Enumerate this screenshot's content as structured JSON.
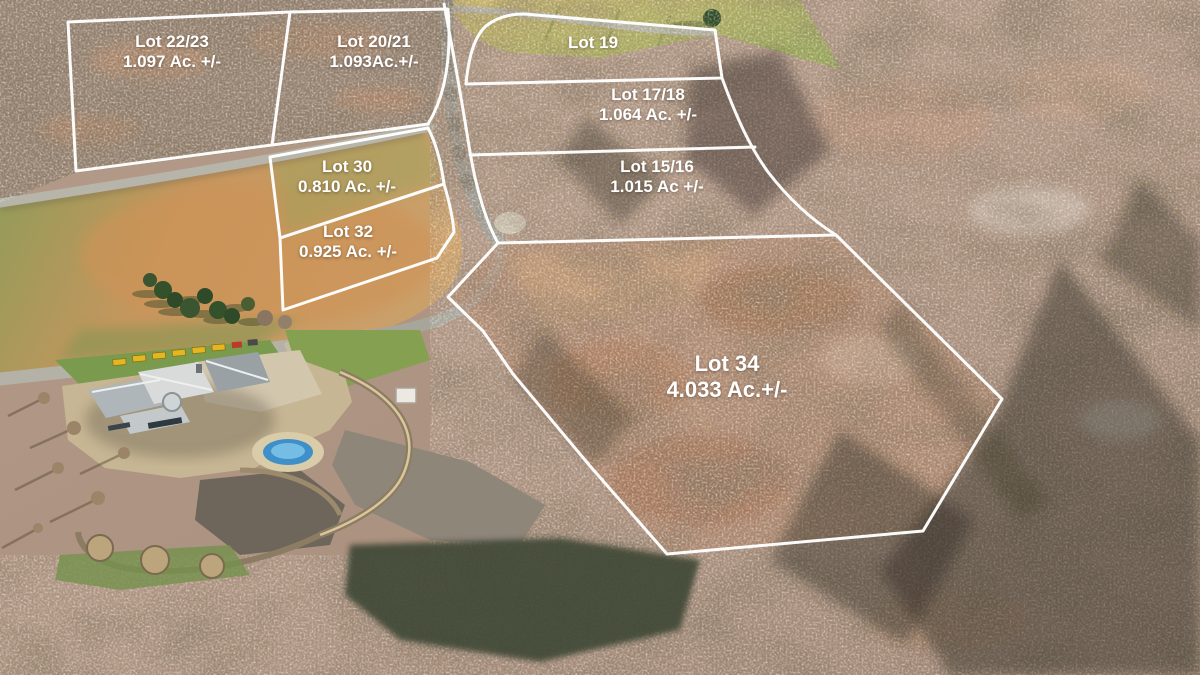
{
  "map": {
    "kind": "aerial-lot-plat",
    "description": "Aerial drone photo of wooded acreage and estate with surveyed lot boundaries overlaid in white"
  },
  "lots": [
    {
      "key": "lot-22-23",
      "name": "Lot 22/23",
      "acreage": "1.097 Ac. +/-"
    },
    {
      "key": "lot-20-21",
      "name": "Lot 20/21",
      "acreage": "1.093Ac.+/-"
    },
    {
      "key": "lot-19",
      "name": "Lot 19",
      "acreage": ""
    },
    {
      "key": "lot-17-18",
      "name": "Lot 17/18",
      "acreage": "1.064 Ac. +/-"
    },
    {
      "key": "lot-15-16",
      "name": "Lot 15/16",
      "acreage": "1.015 Ac +/-"
    },
    {
      "key": "lot-30",
      "name": "Lot 30",
      "acreage": "0.810 Ac. +/-"
    },
    {
      "key": "lot-32",
      "name": "Lot 32",
      "acreage": "0.925 Ac. +/-"
    },
    {
      "key": "lot-34",
      "name": "Lot 34",
      "acreage": "4.033 Ac.+/-"
    }
  ],
  "boundaries": [
    {
      "key": "block-lots-22-23-20-21",
      "path": "M 68,22 L 290,12 L 448,9 C 452,60 444,98 428,124 L 272,145 L 76,171 Z"
    },
    {
      "key": "divider-22-23-20-21",
      "path": "M 290,12 L 272,145"
    },
    {
      "key": "lot-19-outline",
      "path": "M 524,14 L 715,30 L 722,78 L 466,84 C 469,52 476,35 486,26 C 496,18 509,14 524,14 Z"
    },
    {
      "key": "road-east-edge",
      "path": "M 444,4 C 454,56 462,102 470,152 C 476,188 486,222 498,243"
    },
    {
      "key": "east-boundary-curve",
      "path": "M 722,78 C 738,122 752,150 768,172 C 788,198 812,220 836,235"
    },
    {
      "key": "divider-15-16",
      "path": "M 470,155 L 755,147"
    },
    {
      "key": "lot-34-outline",
      "path": "M 498,243 L 836,235 L 1002,399 L 923,531 L 667,554 L 590,466 L 513,374 L 483,331 L 448,297 Z"
    },
    {
      "key": "lot-30-outline",
      "path": "M 270,157 L 428,128 C 436,143 441,162 444,184 L 280,238 Z"
    },
    {
      "key": "lot-32-outline",
      "path": "M 280,238 L 444,184 C 450,204 453,220 454,232 L 437,258 L 283,310 Z"
    }
  ],
  "colors": {
    "boundary_line": "#ffffff",
    "label_text": "#ffffff",
    "forest_canopy": "#b59a88",
    "forest_shadow": "#2e2a22",
    "field_green": "#8d9c58",
    "field_tan": "#cf9a5f",
    "road_gray": "#b4b1a7",
    "pool_blue": "#4a9fd8",
    "equipment_yellow": "#e3b722",
    "evergreen": "#33512b"
  }
}
